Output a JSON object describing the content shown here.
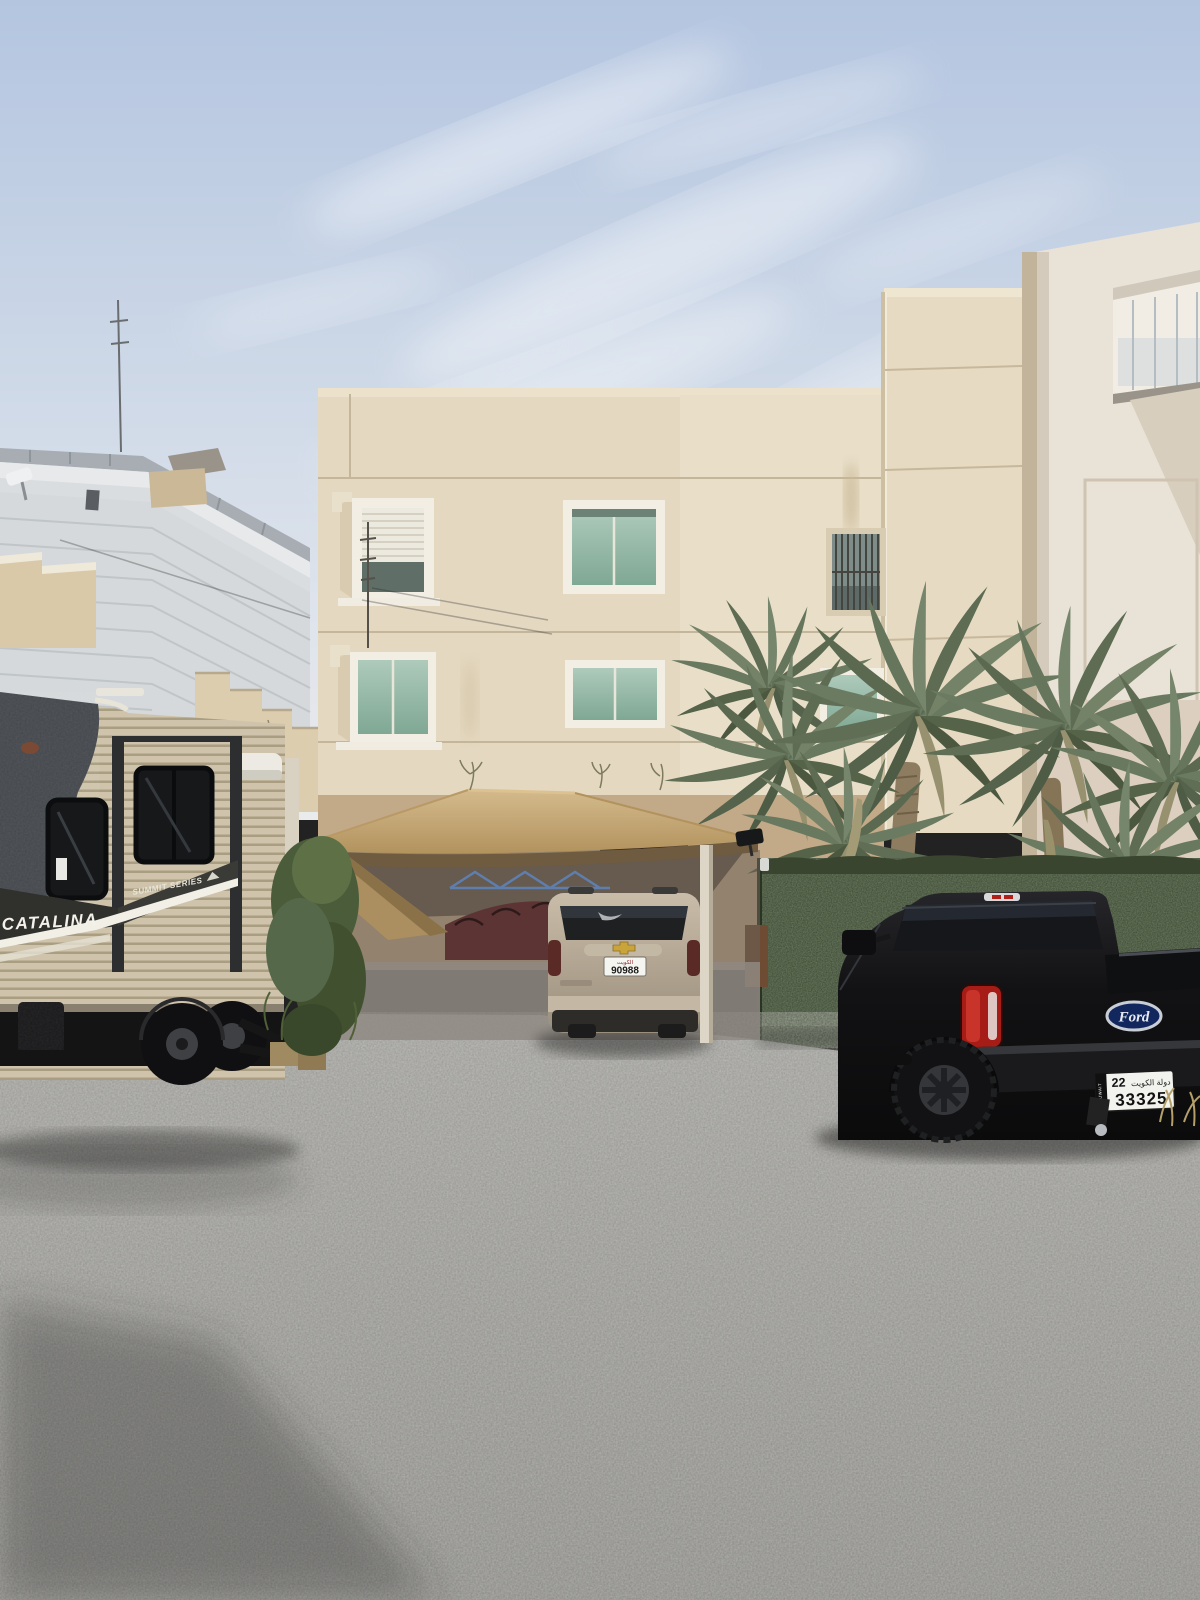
{
  "trailer": {
    "brand": "CATALINA",
    "series": "SUMMIT SERIES"
  },
  "suv": {
    "plate_region": "الكويت",
    "plate_number": "90988"
  },
  "truck": {
    "brand": "Ford",
    "plate_prefix": "22",
    "plate_number": "33325",
    "plate_country": "دولة الكويت",
    "plate_side_text": "KUWAIT"
  },
  "colors": {
    "sky_top": "#b4c5e0",
    "sky_bottom": "#e9ebec",
    "main_building": "#e4d8c0",
    "right_building": "#e9e2d7",
    "left_building": "#d6d9db",
    "canopy": "#c2a36e",
    "fence_green": "#3a4636",
    "ground_gravel": "#9b9b97",
    "trailer_body": "#cdc2a9",
    "suv_body": "#b5a896",
    "truck_body": "#141416",
    "taillight_red": "#b02018",
    "ford_blue": "#12275e",
    "palm_green": "#66765c"
  }
}
